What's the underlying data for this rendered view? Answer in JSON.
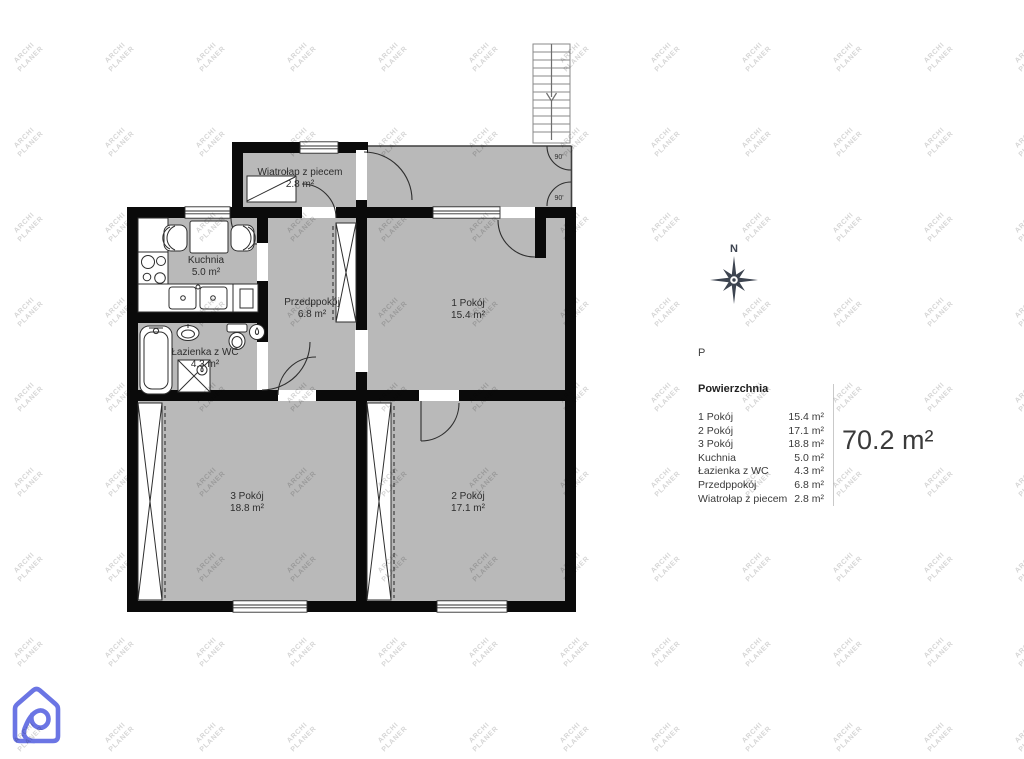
{
  "plan": {
    "rooms": [
      {
        "name": "Wiatrołap z piecem",
        "area": "2.8 m²"
      },
      {
        "name": "Kuchnia",
        "area": "5.0 m²"
      },
      {
        "name": "Łazienka z WC",
        "area": "4.3 m²"
      },
      {
        "name": "Przedppokój",
        "area": "6.8 m²"
      },
      {
        "name": "1 Pokój",
        "area": "15.4 m²"
      },
      {
        "name": "3 Pokój",
        "area": "18.8 m²"
      },
      {
        "name": "2 Pokój",
        "area": "17.1 m²"
      }
    ],
    "door_angle_label": "90'",
    "compass_north_label": "N"
  },
  "legend": {
    "floor_label": "P",
    "title": "Powierzchnia",
    "items": [
      {
        "label": "1 Pokój",
        "value": "15.4 m²"
      },
      {
        "label": "2 Pokój",
        "value": "17.1 m²"
      },
      {
        "label": "3 Pokój",
        "value": "18.8 m²"
      },
      {
        "label": "Kuchnia",
        "value": "5.0 m²"
      },
      {
        "label": "Łazienka z WC",
        "value": "4.3 m²"
      },
      {
        "label": "Przedppokój",
        "value": "6.8 m²"
      },
      {
        "label": "Wiatrołap z piecem",
        "value": "2.8 m²"
      }
    ],
    "total": "70.2 m²"
  },
  "watermark": {
    "line1": "ARCHI",
    "line2": "PLANER"
  },
  "colors": {
    "room_fill": "#b9b9b9",
    "wall": "#0a0a0a",
    "compass": "#3d4450",
    "logo": "#6b75e4",
    "watermark": "#d6d6d6"
  }
}
